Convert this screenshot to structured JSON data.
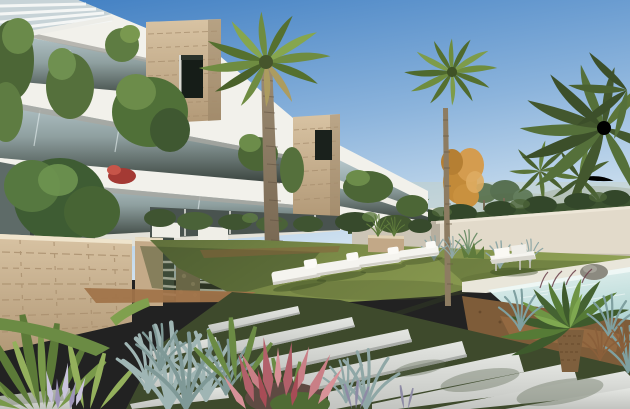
{
  "scene": {
    "type": "architectural-render-photo",
    "description": "Sunny 3D architectural rendering of a modern white apartment complex with stone-clad towers and plant-draped balconies; a large palm and a tall slim palm rise over a lawn with four white sun loungers and a white daybed beside a beige perimeter wall; the corner of a turquoise swimming pool and a cycad sit at the right; a diagonal path of pale stone slabs crosses the foreground between ornamental grasses, agaves and pink flowering plants; distant white villas, pines and palms under a blue sky.",
    "elements": [
      "sky",
      "distant-villas",
      "distant-pines",
      "background-palms",
      "orange-tree",
      "perimeter-wall",
      "hedge",
      "apartment-building",
      "stone-clad-tower",
      "balcony-plants",
      "pergola-louvers",
      "large-palm-tree",
      "tall-palm-tree",
      "garden-bush",
      "stone-wall",
      "lawn",
      "sun-loungers",
      "daybed",
      "swimming-pool",
      "stone-planter",
      "cycad",
      "ornamental-grasses",
      "stone-slab-path",
      "agave-plants",
      "pink-astilbe-flowers"
    ],
    "counts": {
      "sun_loungers": 4,
      "stone_towers": 2
    }
  },
  "palette": {
    "sky_top": "#3F7EC2",
    "sky_mid": "#8CB4DC",
    "sky_horizon": "#D8E7F2",
    "building_white": "#F2F1EB",
    "glass": "#AEC0C5",
    "interior_dark": "#39423C",
    "stone_clad": "#C9AF8E",
    "window_dark": "#1A211C",
    "foliage": "#5E7C42",
    "foliage_dark": "#42572F",
    "foliage_light": "#88A757",
    "palm_trunk": "#8A775B",
    "orange_tree": "#C9913F",
    "hedge": "#3C5230",
    "wall_shaded": "#CCC5B6",
    "wall_lit": "#E2DACA",
    "lawn_light": "#8E9E53",
    "lawn_dark": "#61713C",
    "dirt": "#A1744A",
    "pool_water": "#BFE0DC",
    "pool_coping": "#E9E6DA",
    "slab": "#D9DBD7",
    "path_gap": "#3E4A2C",
    "grass_blue": "#8FA7A6",
    "astilbe_pink": "#B2606A",
    "furniture_white": "#F5F4EF"
  }
}
